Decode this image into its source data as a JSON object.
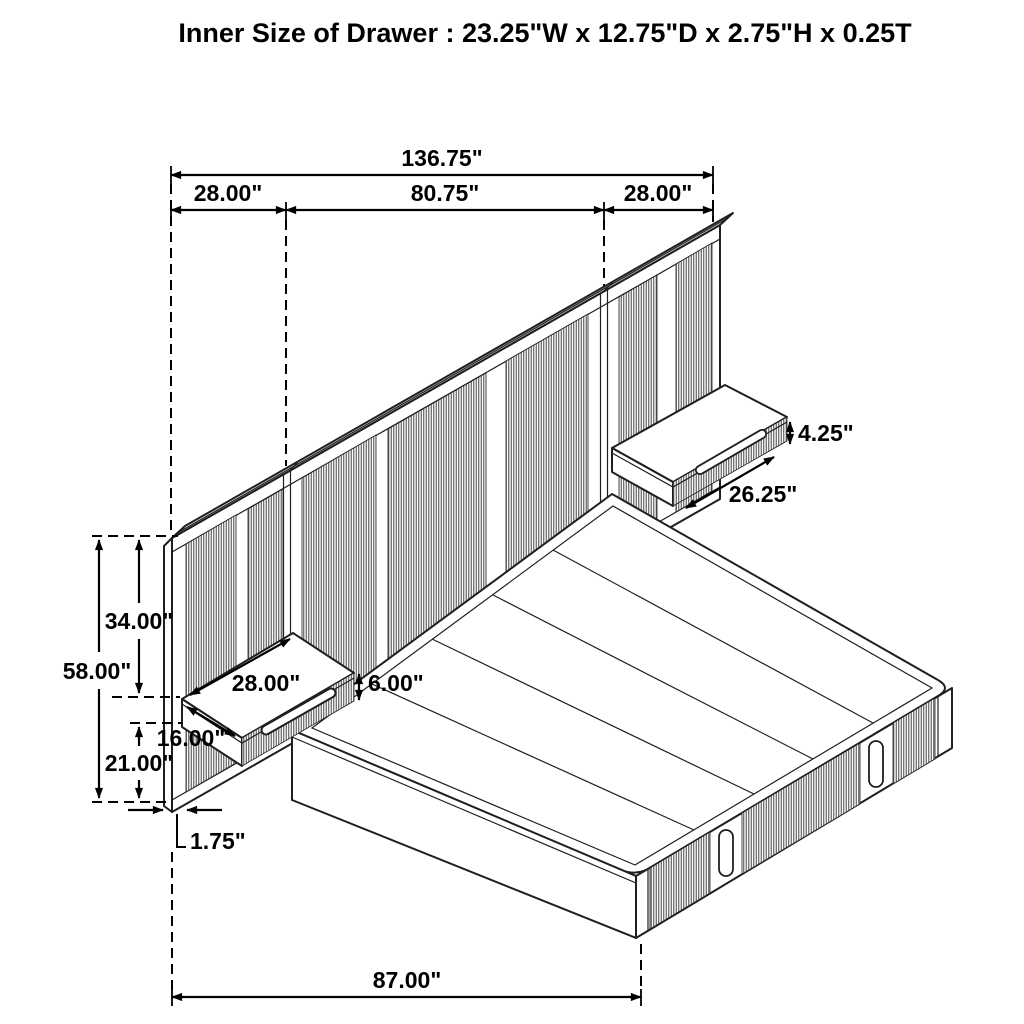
{
  "title": "Inner Size of Drawer : 23.25\"W x 12.75\"D x 2.75\"H x 0.25T",
  "dimensions": {
    "overall_width": "136.75\"",
    "left_panel_width": "28.00\"",
    "headboard_width": "80.75\"",
    "right_panel_width": "28.00\"",
    "right_nightstand_height": "4.25\"",
    "right_nightstand_width": "26.25\"",
    "panel_upper_height": "34.00\"",
    "panel_total_height": "58.00\"",
    "left_nightstand_width": "28.00\"",
    "left_nightstand_height": "6.00\"",
    "left_nightstand_depth": "16.00\"",
    "panel_lower_height": "21.00\"",
    "panel_thickness": "1.75\"",
    "bed_length": "87.00\""
  },
  "colors": {
    "line": "#1f1f1f",
    "dimension": "#000000",
    "rib": "#555555",
    "background": "#ffffff"
  }
}
